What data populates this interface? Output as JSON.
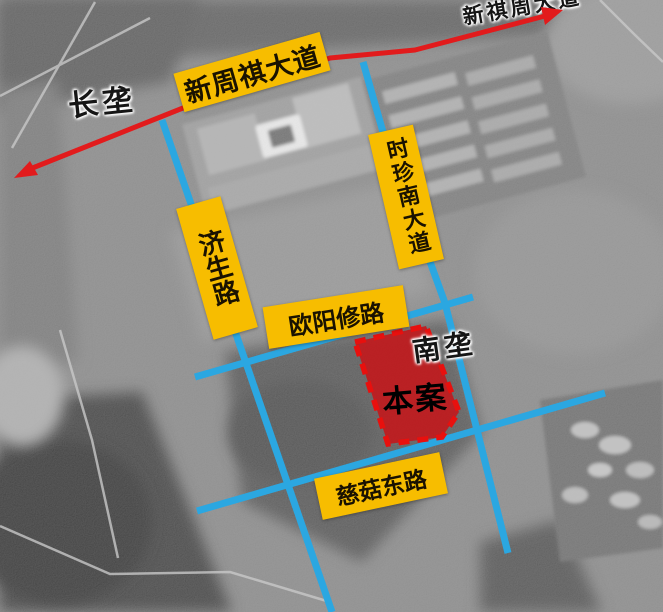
{
  "map": {
    "road_labels": [
      {
        "id": "xinzhouqi-avenue",
        "text": "新周祺大道"
      },
      {
        "id": "jisheng-road",
        "text": "济生路"
      },
      {
        "id": "shizhen-south-avenue",
        "text": "时珍南大道"
      },
      {
        "id": "ouyangxiu-road",
        "text": "欧阳修路"
      },
      {
        "id": "cigu-east-road",
        "text": "慈菇东路"
      }
    ],
    "place_labels": [
      {
        "id": "changlong",
        "text": "长垄"
      },
      {
        "id": "nanlong",
        "text": "南垄"
      },
      {
        "id": "xinqizhou-avenue",
        "text": "新祺周大道"
      }
    ],
    "site": {
      "label": "本案"
    },
    "colors": {
      "road_blue": "#2BA7E1",
      "label_yellow": "#F7BD00",
      "site_fill": "#C01B1E",
      "site_border": "#E8100E",
      "arrow_red": "#E21B1C"
    }
  }
}
